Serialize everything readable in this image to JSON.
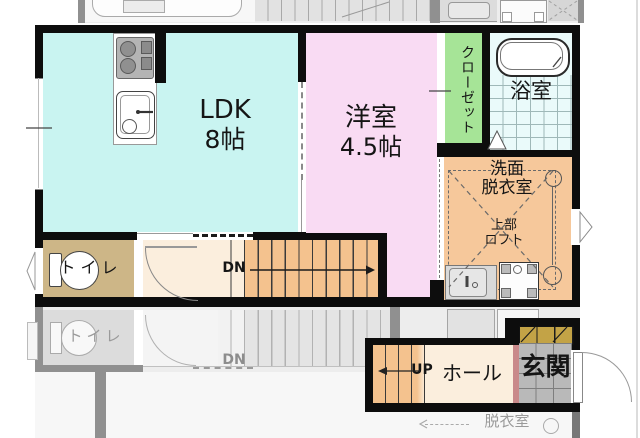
{
  "colors": {
    "wall": "#0d0d0d",
    "ldk": "#c9f4f1",
    "western": "#f9dbf3",
    "closet": "#a6e497",
    "bath": "#eafafa",
    "bath_line": "#9fb8b8",
    "washroom": "#f6c89b",
    "stairs": "#f4c28e",
    "hall": "#fbeedd",
    "toilet_room": "#cdb687",
    "entrance_tile": "#b9b9b9",
    "shoe_cabinet": "#c3a346",
    "door_accent": "#c9898a",
    "faded_wall": "#909090",
    "faded_bg": "#ededed",
    "faded_line": "#b2b2b2"
  },
  "floorplan": {
    "upper": {
      "ldk": {
        "name": "LDK",
        "size": "8帖"
      },
      "western": {
        "name": "洋室",
        "size": "4.5帖"
      },
      "closet": {
        "name": "クローゼット"
      },
      "bath": {
        "name": "浴室"
      },
      "washroom": {
        "line1": "洗面",
        "line2": "脱衣室"
      },
      "loft": {
        "line1": "上部",
        "line2": "ロフト"
      },
      "toilet": {
        "name": "トイレ"
      },
      "stairs_dn": {
        "label": "DN"
      }
    },
    "lower": {
      "stairs_up": {
        "label": "UP"
      },
      "hall": {
        "name": "ホール"
      },
      "entrance": {
        "name": "玄関"
      }
    },
    "faded": {
      "stairs_dn": {
        "label": "DN"
      },
      "toilet": {
        "name": "トイレ"
      },
      "washroom": {
        "name": "脱衣室"
      }
    }
  }
}
